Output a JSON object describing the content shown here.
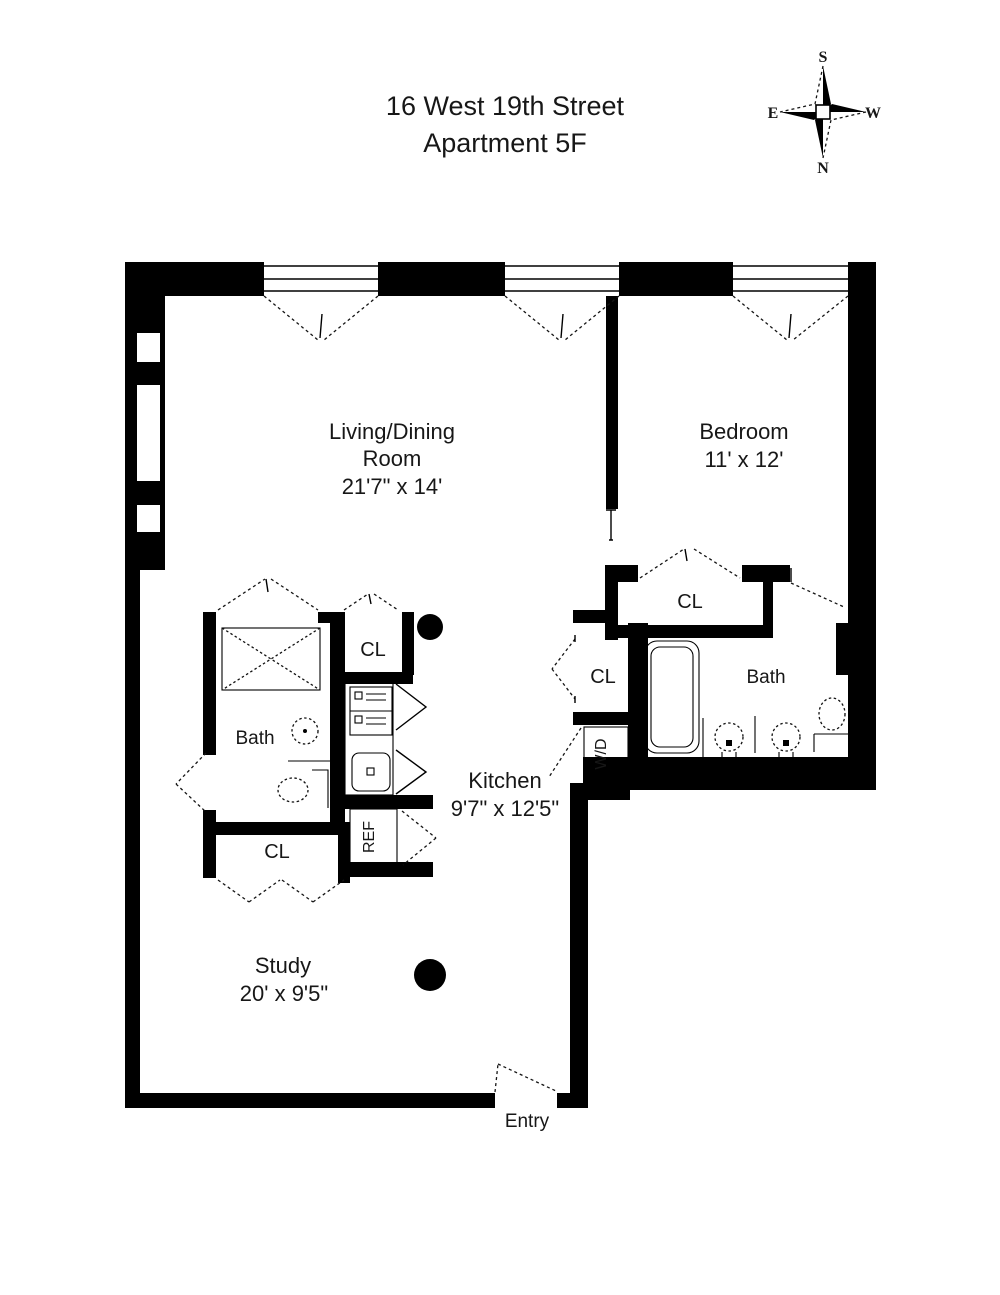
{
  "title": {
    "line1": "16 West 19th Street",
    "line2": "Apartment 5F"
  },
  "compass": {
    "top": "S",
    "bottom": "N",
    "left": "E",
    "right": "W"
  },
  "rooms": {
    "living_dining": {
      "name_line1": "Living/Dining",
      "name_line2": "Room",
      "dimensions": "21'7\" x 14'"
    },
    "bedroom": {
      "name": "Bedroom",
      "dimensions": "11' x 12'"
    },
    "kitchen": {
      "name": "Kitchen",
      "dimensions": "9'7\" x 12'5\""
    },
    "study": {
      "name": "Study",
      "dimensions": "20' x 9'5\""
    },
    "master_bath": {
      "name": "Bath"
    },
    "second_bath": {
      "name": "Bath"
    }
  },
  "labels": {
    "closet": "CL",
    "refrigerator": "REF",
    "washer_dryer": "W/D",
    "entry": "Entry"
  },
  "colors": {
    "wall": "#000000",
    "background": "#ffffff",
    "text": "#171717"
  }
}
